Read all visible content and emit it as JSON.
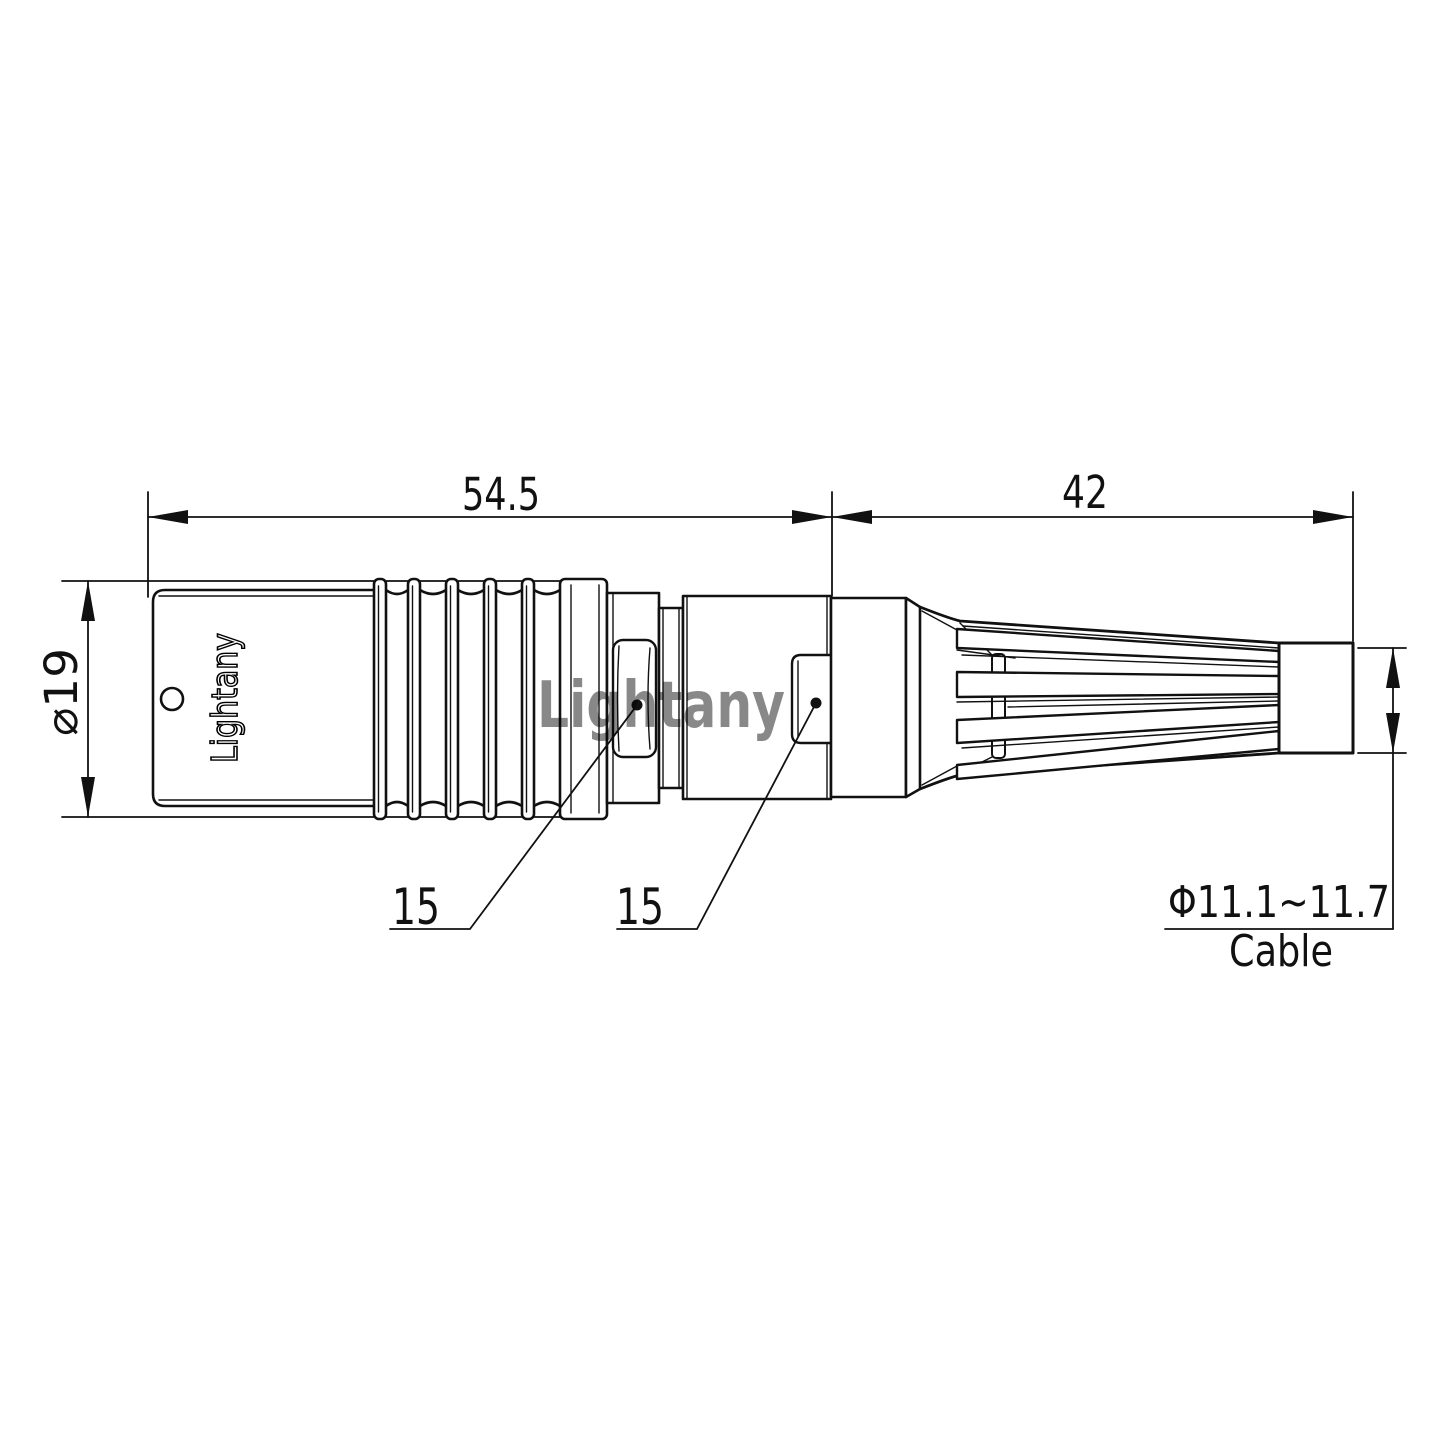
{
  "drawing": {
    "type": "connector-dimension-drawing",
    "background": "#ffffff",
    "line_color": "#111111"
  },
  "watermark": {
    "text": "Lightany",
    "color": "#e08c8c"
  },
  "connector": {
    "engraving": "Lightany"
  },
  "dimensions": {
    "front_length": "54.5",
    "rear_length": "42",
    "shell_diameter": "⌀19",
    "front_flats": "15",
    "rear_flats": "15",
    "cable_diameter_range": "Φ11.1~11.7",
    "cable_label": "Cable"
  }
}
